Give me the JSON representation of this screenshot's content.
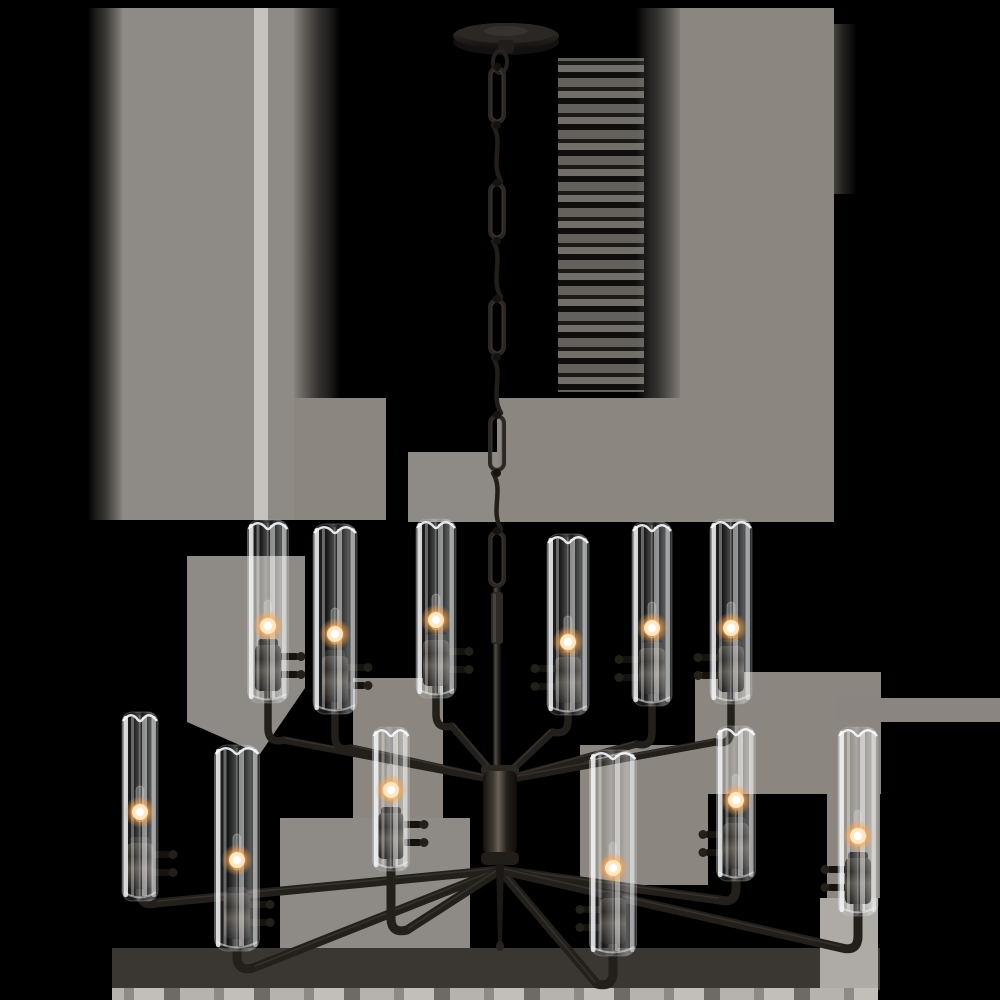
{
  "meta": {
    "alt": "Twelve-light two-tier chandelier in dark aged bronze with tall clear glass cylinder shades, suspended by an oval-link chain from a round ceiling canopy; small tubular candelabra bulbs glow warm white inside each glass shade. Transparent background rendered black with rectangular gray matte artifact patches.",
    "subject": "two-tier chandelier product photo",
    "lights_total": 12,
    "lights_upper": 6,
    "lights_lower": 6,
    "glass": "clear cylinder shades",
    "bulbs_lit": true
  },
  "canvas": {
    "width": 1000,
    "height": 1000
  },
  "colors": {
    "background": "#000000",
    "halo_gray": "#8e8a85",
    "halo_gray_warm": "#8b8680",
    "halo_light": "#c6c3bf",
    "halo_dark_band": "#3a3733",
    "bottom_strip": "#b5b2ae",
    "metal_dark": "#1d1a17",
    "metal_mid": "#36302a",
    "metal_highlight": "#6a635a",
    "glass_white": "#f4f7fa",
    "glow_core": "#ffffff",
    "glow_warm": "#ffc981"
  },
  "halo": {
    "patches": [
      {
        "name": "left-fade",
        "x": 88,
        "y": 8,
        "w": 34,
        "h": 512,
        "fill": "fadeL"
      },
      {
        "name": "left-block",
        "x": 122,
        "y": 8,
        "w": 132,
        "h": 512,
        "fill": "#8e8a85"
      },
      {
        "name": "left-light-strip",
        "x": 254,
        "y": 8,
        "w": 14,
        "h": 512,
        "fill": "#c6c3bf"
      },
      {
        "name": "left-block-2",
        "x": 268,
        "y": 8,
        "w": 26,
        "h": 512,
        "fill": "#8e8a85"
      },
      {
        "name": "left-fade-2",
        "x": 294,
        "y": 8,
        "w": 46,
        "h": 512,
        "fill": "fadeR"
      },
      {
        "name": "left-ext",
        "x": 294,
        "y": 398,
        "w": 92,
        "h": 122,
        "fill": "#8b8780"
      },
      {
        "name": "chain-streaks",
        "x": 558,
        "y": 58,
        "w": 86,
        "h": 334,
        "fill": "streakH",
        "opacity": 0.8
      },
      {
        "name": "right-fade",
        "x": 636,
        "y": 8,
        "w": 46,
        "h": 514,
        "fill": "fadeL"
      },
      {
        "name": "right-block",
        "x": 680,
        "y": 8,
        "w": 154,
        "h": 514,
        "fill": "#8b8680"
      },
      {
        "name": "right-edge-fade",
        "x": 834,
        "y": 24,
        "w": 22,
        "h": 170,
        "fill": "fadeR",
        "opacity": 0.5
      },
      {
        "name": "mid-right-band",
        "x": 497,
        "y": 398,
        "w": 185,
        "h": 124,
        "fill": "#8b8680"
      },
      {
        "name": "mid-left-band",
        "x": 408,
        "y": 452,
        "w": 90,
        "h": 70,
        "fill": "#8e8a85"
      },
      {
        "name": "tier-wedge-left",
        "points": "187,556 305,556 305,688 260,754 187,722",
        "fill": "#8e8a85"
      },
      {
        "name": "tier-patch-left-2",
        "x": 353,
        "y": 678,
        "w": 90,
        "h": 142,
        "fill": "#8b8780"
      },
      {
        "name": "tier-patch-right",
        "x": 695,
        "y": 672,
        "w": 186,
        "h": 122,
        "fill": "#8b8680"
      },
      {
        "name": "right-band-edge",
        "x": 836,
        "y": 698,
        "w": 164,
        "h": 24,
        "fill": "#8a8580"
      },
      {
        "name": "right-col-low",
        "x": 827,
        "y": 722,
        "w": 53,
        "h": 176,
        "fill": "#8b8680"
      },
      {
        "name": "center-wedge-right",
        "x": 580,
        "y": 745,
        "w": 128,
        "h": 140,
        "fill": "#8b8680"
      },
      {
        "name": "center-wedge-left",
        "x": 280,
        "y": 818,
        "w": 190,
        "h": 134,
        "fill": "#8e8a85"
      },
      {
        "name": "bottom-dark-band",
        "x": 112,
        "y": 948,
        "w": 768,
        "h": 42,
        "fill": "#3a3733"
      },
      {
        "name": "bottom-right-patch",
        "x": 820,
        "y": 898,
        "w": 58,
        "h": 92,
        "fill": "#aeaaa5"
      },
      {
        "name": "bottom-strip",
        "x": 112,
        "y": 988,
        "w": 766,
        "h": 12,
        "fill": "streakS"
      }
    ]
  },
  "canopy": {
    "cx": 506,
    "cy": 36,
    "rx": 53,
    "ry": 13
  },
  "chain": {
    "cx": 497,
    "top": 66,
    "bottom": 588,
    "links": 9
  },
  "stem": {
    "cx": 497,
    "top": 588,
    "bottom": 768
  },
  "hub": {
    "cx": 500,
    "top": 765,
    "w": 34,
    "h": 100
  },
  "finial": {
    "top": 864,
    "bottom": 942
  },
  "tiers": [
    {
      "name": "upper",
      "attach_y": 781,
      "arm_width": 7.5,
      "lights": [
        {
          "x": 268,
          "top": 520,
          "socket_y": 645,
          "glow_y": 626,
          "elbow_y": 740,
          "w": 41
        },
        {
          "x": 335,
          "top": 524,
          "socket_y": 656,
          "glow_y": 634,
          "elbow_y": 748,
          "w": 44
        },
        {
          "x": 436,
          "top": 519,
          "socket_y": 640,
          "glow_y": 620,
          "elbow_y": 726,
          "w": 40
        },
        {
          "x": 568,
          "top": 534,
          "socket_y": 657,
          "glow_y": 642,
          "elbow_y": 732,
          "w": 42
        },
        {
          "x": 652,
          "top": 522,
          "socket_y": 648,
          "glow_y": 628,
          "elbow_y": 744,
          "w": 40
        },
        {
          "x": 731,
          "top": 519,
          "socket_y": 646,
          "glow_y": 628,
          "elbow_y": 742,
          "w": 42
        }
      ]
    },
    {
      "name": "lower",
      "attach_y": 870,
      "arm_width": 9,
      "lights": [
        {
          "x": 140,
          "top": 712,
          "socket_y": 843,
          "glow_y": 812,
          "elbow_y": 903,
          "w": 36
        },
        {
          "x": 237,
          "top": 745,
          "socket_y": 893,
          "glow_y": 860,
          "elbow_y": 968,
          "w": 45
        },
        {
          "x": 391,
          "top": 727,
          "socket_y": 813,
          "glow_y": 790,
          "elbow_y": 930,
          "w": 37
        },
        {
          "x": 613,
          "top": 750,
          "socket_y": 898,
          "glow_y": 868,
          "elbow_y": 984,
          "w": 47
        },
        {
          "x": 736,
          "top": 726,
          "socket_y": 823,
          "glow_y": 800,
          "elbow_y": 900,
          "w": 39
        },
        {
          "x": 858,
          "top": 727,
          "socket_y": 858,
          "glow_y": 836,
          "elbow_y": 948,
          "w": 40
        }
      ]
    }
  ]
}
